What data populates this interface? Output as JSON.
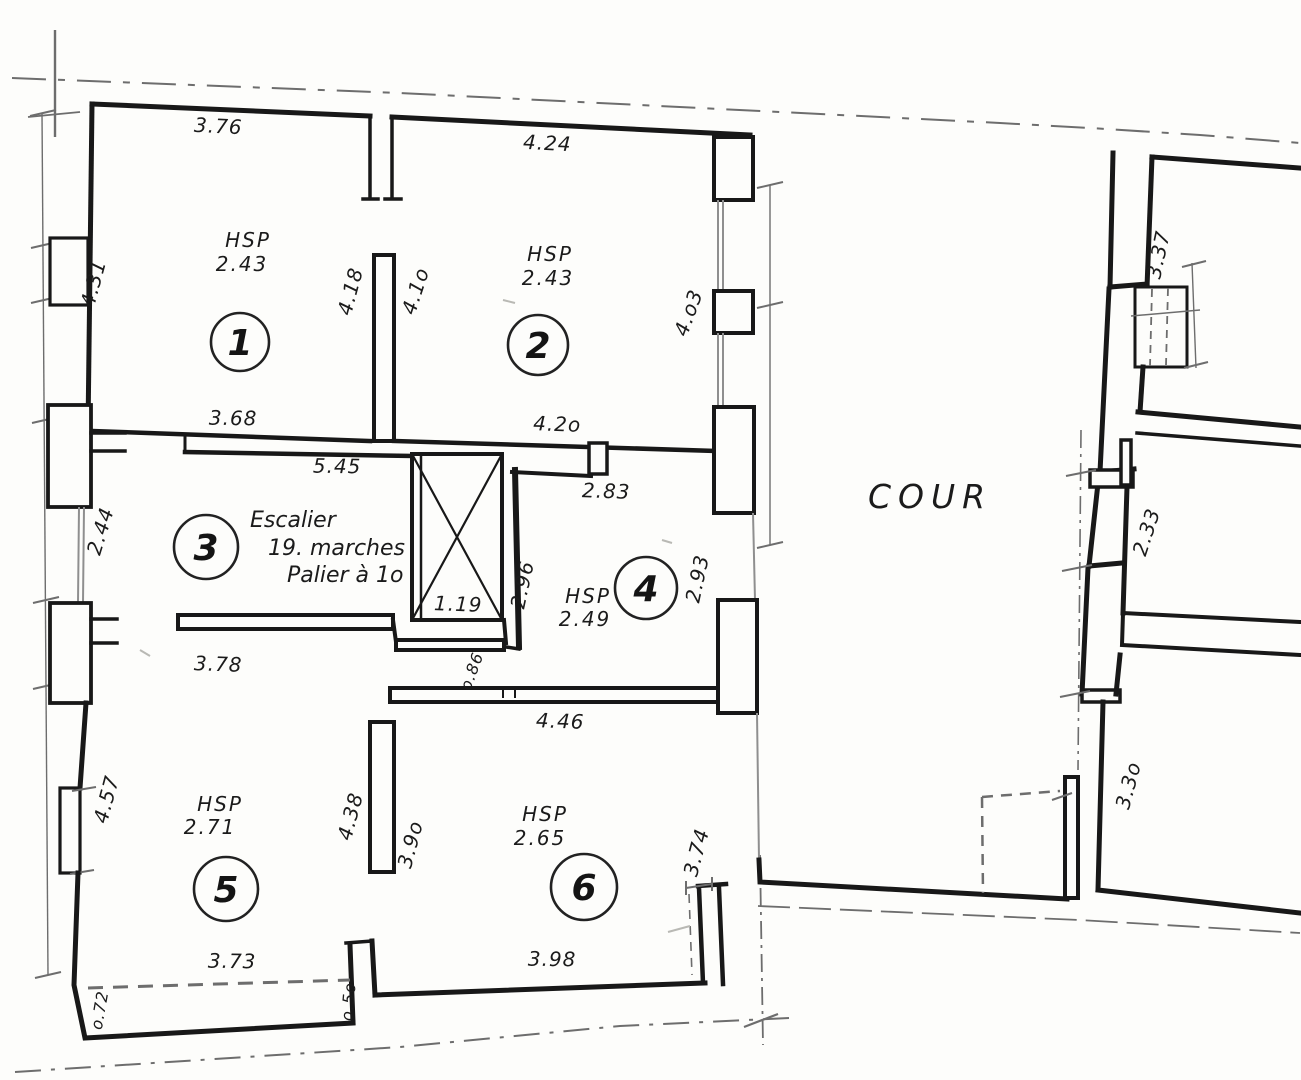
{
  "plan": {
    "courtyard_label": "COUR",
    "palette": {
      "ink": "#1b1b1b",
      "paper": "#fdfdfb"
    },
    "rooms": [
      {
        "number": "1",
        "hsp_title": "HSP",
        "hsp_value": "2.43"
      },
      {
        "number": "2",
        "hsp_title": "HSP",
        "hsp_value": "2.43"
      },
      {
        "number": "3",
        "note1": "Escalier",
        "note2": "19. marches",
        "note3": "Palier à 1o"
      },
      {
        "number": "4",
        "hsp_title": "HSP",
        "hsp_value": "2.49"
      },
      {
        "number": "5",
        "hsp_title": "HSP",
        "hsp_value": "2.71"
      },
      {
        "number": "6",
        "hsp_title": "HSP",
        "hsp_value": "2.65"
      }
    ],
    "dims": {
      "room1_top": "3.76",
      "room2_top": "4.24",
      "room1_left": "4.31",
      "wall12_left": "4.18",
      "wall12_right": "4.1o",
      "room2_right": "4.o3",
      "room1_bottom": "3.68",
      "room2_bottom": "4.2o",
      "room3_top": "5.45",
      "room4_top": "2.83",
      "room3_left": "2.44",
      "room4_left": "2.96",
      "shaft_width": "1.19",
      "room4_right": "2.93",
      "room3_bottom": "3.78",
      "door_opening": "o.86",
      "room6_top": "4.46",
      "room5_left": "4.57",
      "wall56_left": "4.38",
      "wall56_right": "3.9o",
      "room6_right": "3.74",
      "room5_bottom": "3.73",
      "room5_corner": "o.72",
      "room56_gap": "o.5o",
      "room6_bottom": "3.98",
      "east_room_top": "3.37",
      "east_room_mid": "2.33",
      "east_room_bottom": "3.3o"
    }
  }
}
